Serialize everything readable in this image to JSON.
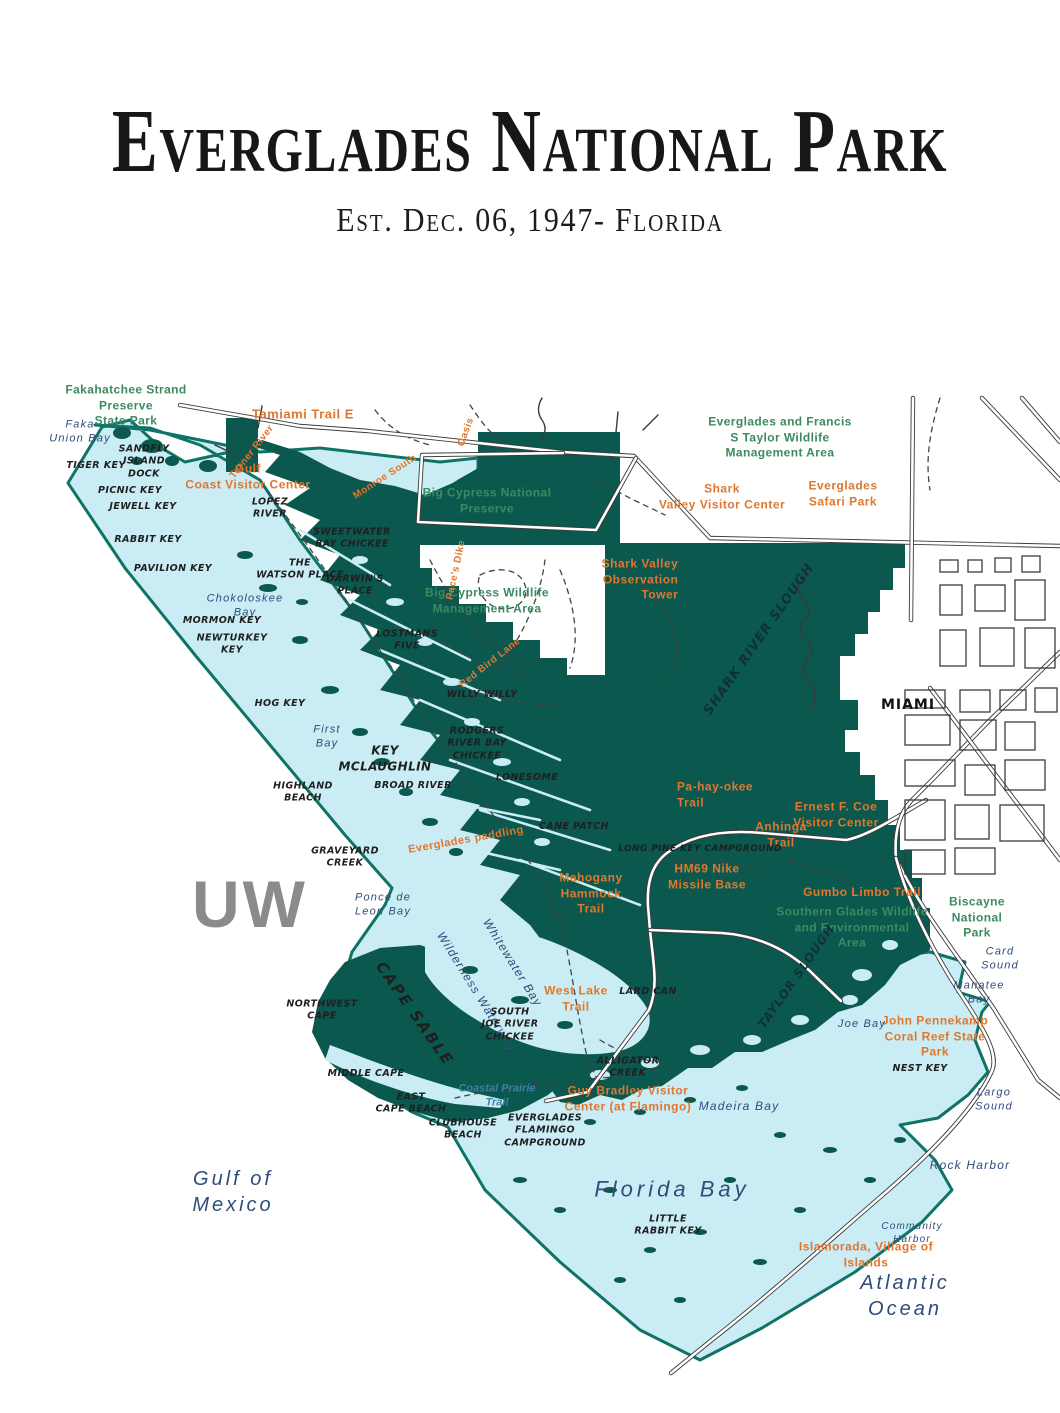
{
  "header": {
    "title": "Everglades National Park",
    "subtitle": "Est. Dec. 06, 1947- Florida"
  },
  "watermark": "UW",
  "colors": {
    "park_fill": "#0a584e",
    "water_fill": "#c9ecf5",
    "boundary_stroke": "#0f7465",
    "road_stroke": "#3b3b3b",
    "label_green": "#3c8a60",
    "label_orange": "#e0772e",
    "label_navy": "#2e4d7b",
    "label_feature": "#1f1f1f",
    "watermark_gray": "#8b8b8b"
  },
  "map": {
    "labels": [
      {
        "name": "label-fakahatchee",
        "type": "green",
        "x": 126,
        "y": 406,
        "text": "Fakahatchee Strand\nPreserve\nState Park"
      },
      {
        "name": "label-big-cypress-preserve",
        "type": "green",
        "x": 487,
        "y": 501,
        "text": "Big Cypress National\nPreserve"
      },
      {
        "name": "label-big-cypress-wma",
        "type": "green",
        "x": 487,
        "y": 601,
        "text": "Big Cypress Wildlife\nManagement Area"
      },
      {
        "name": "label-taylor-wma",
        "type": "green",
        "x": 780,
        "y": 438,
        "text": "Everglades and Francis\nS Taylor Wildlife\nManagement Area"
      },
      {
        "name": "label-southern-glades",
        "type": "green",
        "x": 852,
        "y": 928,
        "text": "Southern Glades Wildlife\nand Environmental\nArea"
      },
      {
        "name": "label-biscayne",
        "type": "green",
        "x": 977,
        "y": 918,
        "text": "Biscayne\nNational\nPark"
      },
      {
        "name": "label-tamiami-trail",
        "type": "orange",
        "x": 303,
        "y": 415,
        "size": 13,
        "text": "Tamiami Trail E"
      },
      {
        "name": "label-gulf-coast-vc",
        "type": "orange",
        "x": 248,
        "y": 477,
        "text": "Gulf\nCoast Visitor Center"
      },
      {
        "name": "label-turner-river",
        "type": "orange",
        "x": 252,
        "y": 452,
        "rotate": -52,
        "size": 10,
        "text": "Turner River"
      },
      {
        "name": "label-monroe-south",
        "type": "orange",
        "x": 385,
        "y": 477,
        "rotate": -33,
        "size": 10,
        "text": "Monroe South"
      },
      {
        "name": "label-oasis-trail",
        "type": "orange",
        "x": 466,
        "y": 432,
        "rotate": -70,
        "size": 10,
        "text": "Oasis"
      },
      {
        "name": "label-paces-dike",
        "type": "orange",
        "x": 456,
        "y": 570,
        "rotate": -78,
        "size": 10,
        "text": "Pace's Dike"
      },
      {
        "name": "label-red-bird-lane",
        "type": "orange",
        "x": 490,
        "y": 663,
        "rotate": -38,
        "size": 10,
        "text": "Red Bird Lane"
      },
      {
        "name": "label-shark-valley-tower",
        "type": "orange",
        "x": 640,
        "y": 580,
        "align": "right",
        "text": "Shark Valley\nObservation\nTower"
      },
      {
        "name": "label-shark-valley-vc",
        "type": "orange",
        "x": 722,
        "y": 497,
        "text": "Shark\nValley Visitor Center"
      },
      {
        "name": "label-safari-park",
        "type": "orange",
        "x": 843,
        "y": 494,
        "text": "Everglades\nSafari Park"
      },
      {
        "name": "label-pa-hay-okee",
        "type": "orange",
        "x": 715,
        "y": 795,
        "align": "left",
        "text": "Pa-hay-okee\nTrail"
      },
      {
        "name": "label-anhinga",
        "type": "orange",
        "x": 781,
        "y": 835,
        "text": "Anhinga\nTrail"
      },
      {
        "name": "label-ernest-coe",
        "type": "orange",
        "x": 836,
        "y": 815,
        "text": "Ernest F. Coe\nVisitor Center"
      },
      {
        "name": "label-gumbo-limbo",
        "type": "orange",
        "x": 862,
        "y": 893,
        "text": "Gumbo Limbo Trail"
      },
      {
        "name": "label-hm69",
        "type": "orange",
        "x": 707,
        "y": 877,
        "text": "HM69 Nike\nMissile Base"
      },
      {
        "name": "label-mahogany",
        "type": "orange",
        "x": 591,
        "y": 894,
        "text": "Mahogany\nHammock\nTrail"
      },
      {
        "name": "label-everglades-paddling",
        "type": "orange",
        "x": 466,
        "y": 840,
        "rotate": -10,
        "size": 11,
        "text": "Everglades paddling"
      },
      {
        "name": "label-west-lake-trail",
        "type": "orange",
        "x": 576,
        "y": 999,
        "text": "West Lake\nTrail"
      },
      {
        "name": "label-guy-bradley",
        "type": "orange",
        "x": 628,
        "y": 1099,
        "text": "Guy Bradley Visitor\nCenter (at Flamingo)"
      },
      {
        "name": "label-pennekamp",
        "type": "orange",
        "x": 935,
        "y": 1037,
        "text": "John Pennekamp\nCoral Reef State Park"
      },
      {
        "name": "label-islamorada",
        "type": "orange",
        "x": 866,
        "y": 1255,
        "text": "Islamorada, Village of\nIslands"
      },
      {
        "name": "label-faka-union-bay",
        "type": "navy",
        "x": 80,
        "y": 432,
        "size": 11,
        "text": "Faka\nUnion Bay"
      },
      {
        "name": "label-chokoloskee-bay",
        "type": "navy",
        "x": 245,
        "y": 606,
        "size": 11,
        "text": "Chokoloskee\nBay"
      },
      {
        "name": "label-first-bay",
        "type": "navy",
        "x": 327,
        "y": 737,
        "size": 11,
        "text": "First\nBay"
      },
      {
        "name": "label-ponce-de-leon-bay",
        "type": "navy",
        "x": 383,
        "y": 905,
        "size": 11,
        "text": "Ponce de\nLeon Bay"
      },
      {
        "name": "label-whitewater-bay",
        "type": "navy",
        "x": 512,
        "y": 963,
        "rotate": 58,
        "size": 12,
        "text": "Whitewater Bay"
      },
      {
        "name": "label-wilderness-waterway",
        "type": "navy",
        "x": 476,
        "y": 992,
        "rotate": 58,
        "size": 12,
        "text": "Wilderness Waterway"
      },
      {
        "name": "label-gulf-of-mexico",
        "type": "navy",
        "x": 233,
        "y": 1192,
        "size": 20,
        "letterspacing": 3,
        "text": "Gulf of\nMexico"
      },
      {
        "name": "label-florida-bay",
        "type": "navy",
        "x": 672,
        "y": 1190,
        "size": 22,
        "letterspacing": 4,
        "text": "Florida Bay"
      },
      {
        "name": "label-madeira-bay",
        "type": "navy",
        "x": 739,
        "y": 1107,
        "size": 12,
        "text": "Madeira Bay"
      },
      {
        "name": "label-joe-bay",
        "type": "navy",
        "x": 862,
        "y": 1024,
        "size": 11,
        "text": "Joe Bay"
      },
      {
        "name": "label-manatee-bay",
        "type": "navy",
        "x": 979,
        "y": 993,
        "size": 11,
        "text": "Manatee\nBay"
      },
      {
        "name": "label-card-sound",
        "type": "navy",
        "x": 1000,
        "y": 959,
        "size": 11,
        "text": "Card\nSound"
      },
      {
        "name": "label-largo-sound",
        "type": "navy",
        "x": 994,
        "y": 1100,
        "size": 11,
        "text": "Largo\nSound"
      },
      {
        "name": "label-rock-harbor",
        "type": "navy",
        "x": 970,
        "y": 1166,
        "size": 12,
        "text": "Rock Harbor"
      },
      {
        "name": "label-community-harbor",
        "type": "navy",
        "x": 912,
        "y": 1233,
        "size": 10,
        "text": "Community\nHarbor"
      },
      {
        "name": "label-atlantic-ocean",
        "type": "navy",
        "x": 905,
        "y": 1296,
        "size": 20,
        "letterspacing": 3,
        "text": "Atlantic\nOcean"
      },
      {
        "name": "label-coastal-prairie-trail",
        "type": "blue-trail",
        "x": 497,
        "y": 1096,
        "text": "Coastal Prairie\nTrail"
      },
      {
        "name": "label-tiger-key",
        "type": "feature",
        "x": 96,
        "y": 466,
        "text": "TIGER KEY"
      },
      {
        "name": "label-sandfly-island-dock",
        "type": "feature",
        "x": 144,
        "y": 462,
        "text": "SANDFLY\nISLAND\nDOCK"
      },
      {
        "name": "label-picnic-key",
        "type": "feature",
        "x": 130,
        "y": 491,
        "text": "PICNIC KEY"
      },
      {
        "name": "label-jewell-key",
        "type": "feature",
        "x": 143,
        "y": 507,
        "text": "JEWELL KEY"
      },
      {
        "name": "label-rabbit-key",
        "type": "feature",
        "x": 148,
        "y": 540,
        "text": "RABBIT KEY"
      },
      {
        "name": "label-pavilion-key",
        "type": "feature",
        "x": 173,
        "y": 569,
        "text": "PAVILION KEY"
      },
      {
        "name": "label-lopez-river",
        "type": "feature",
        "x": 270,
        "y": 509,
        "text": "LOPEZ\nRIVER"
      },
      {
        "name": "label-sweetwater-chickee",
        "type": "feature",
        "x": 352,
        "y": 539,
        "text": "SWEETWATER\nBAY CHICKEE"
      },
      {
        "name": "label-watson-place",
        "type": "feature",
        "x": 300,
        "y": 570,
        "text": "THE\nWATSON PLACE"
      },
      {
        "name": "label-darwins-place",
        "type": "feature",
        "x": 355,
        "y": 586,
        "text": "DARWIN'S\nPLACE"
      },
      {
        "name": "label-mormon-key",
        "type": "feature",
        "x": 222,
        "y": 621,
        "text": "MORMON KEY"
      },
      {
        "name": "label-newturkey-key",
        "type": "feature",
        "x": 232,
        "y": 645,
        "text": "NEWTURKEY\nKEY"
      },
      {
        "name": "label-lostmans-five",
        "type": "feature",
        "x": 407,
        "y": 641,
        "text": "LOSTMANS\nFIVE"
      },
      {
        "name": "label-willy-willy",
        "type": "feature",
        "x": 482,
        "y": 695,
        "text": "WILLY WILLY"
      },
      {
        "name": "label-hog-key",
        "type": "feature",
        "x": 280,
        "y": 704,
        "text": "HOG KEY"
      },
      {
        "name": "label-rodgers-chickee",
        "type": "feature",
        "x": 477,
        "y": 744,
        "text": "RODGERS\nRIVER BAY\nCHICKEE"
      },
      {
        "name": "label-key-mclaughlin",
        "type": "feature",
        "x": 385,
        "y": 759,
        "size": 12,
        "text": "KEY\nMCLAUGHLIN"
      },
      {
        "name": "label-lonesome",
        "type": "feature",
        "x": 527,
        "y": 778,
        "text": "LONESOME"
      },
      {
        "name": "label-broad-river",
        "type": "feature",
        "x": 413,
        "y": 786,
        "text": "BROAD RIVER"
      },
      {
        "name": "label-highland-beach",
        "type": "feature",
        "x": 303,
        "y": 793,
        "text": "HIGHLAND\nBEACH"
      },
      {
        "name": "label-cane-patch",
        "type": "feature",
        "x": 574,
        "y": 827,
        "text": "CANE PATCH"
      },
      {
        "name": "label-graveyard-creek",
        "type": "feature",
        "x": 345,
        "y": 858,
        "text": "GRAVEYARD\nCREEK"
      },
      {
        "name": "label-long-pine-campground",
        "type": "feature",
        "x": 700,
        "y": 850,
        "size": 9,
        "text": "LONG PINE KEY CAMPGROUND"
      },
      {
        "name": "label-northwest-cape",
        "type": "feature",
        "x": 322,
        "y": 1011,
        "text": "NORTHWEST\nCAPE"
      },
      {
        "name": "label-cape-sable",
        "type": "feature",
        "x": 414,
        "y": 1014,
        "rotate": 55,
        "size": 15,
        "letterspacing": 2,
        "text": "CAPE SABLE"
      },
      {
        "name": "label-south-joe-chickee",
        "type": "feature",
        "x": 510,
        "y": 1025,
        "text": "SOUTH\nJOE RIVER\nCHICKEE"
      },
      {
        "name": "label-middle-cape",
        "type": "feature",
        "x": 366,
        "y": 1074,
        "text": "MIDDLE CAPE"
      },
      {
        "name": "label-east-cape-beach",
        "type": "feature",
        "x": 411,
        "y": 1104,
        "text": "EAST\nCAPE BEACH"
      },
      {
        "name": "label-clubhouse-beach",
        "type": "feature",
        "x": 463,
        "y": 1130,
        "text": "CLUBHOUSE\nBEACH"
      },
      {
        "name": "label-flamingo-campground",
        "type": "feature",
        "x": 545,
        "y": 1131,
        "text": "EVERGLADES\nFLAMINGO\nCAMPGROUND"
      },
      {
        "name": "label-alligator-creek",
        "type": "feature",
        "x": 628,
        "y": 1068,
        "text": "ALLIGATOR\nCREEK"
      },
      {
        "name": "label-lard-can",
        "type": "feature",
        "x": 648,
        "y": 992,
        "text": "LARD CAN"
      },
      {
        "name": "label-little-rabbit-key",
        "type": "feature",
        "x": 668,
        "y": 1226,
        "text": "LITTLE\nRABBIT KEY"
      },
      {
        "name": "label-nest-key",
        "type": "feature",
        "x": 920,
        "y": 1069,
        "text": "NEST KEY"
      },
      {
        "name": "label-miami",
        "type": "city",
        "x": 908,
        "y": 705,
        "size": 14,
        "letterspacing": 1,
        "text": "MIAMI"
      },
      {
        "name": "label-shark-river-slough",
        "type": "slough",
        "x": 760,
        "y": 640,
        "rotate": -55,
        "size": 13,
        "letterspacing": 1,
        "text": "SHARK RIVER SLOUGH"
      },
      {
        "name": "label-taylor-slough",
        "type": "slough",
        "x": 797,
        "y": 977,
        "rotate": -55,
        "size": 12,
        "letterspacing": 1,
        "text": "TAYLOR SLOUGH"
      }
    ]
  }
}
